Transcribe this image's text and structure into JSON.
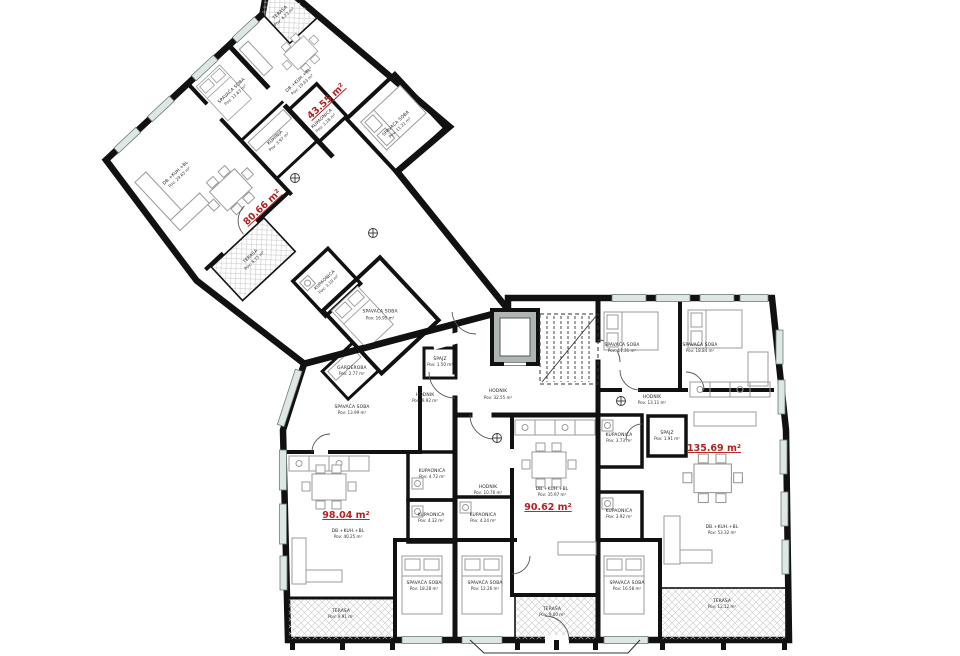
{
  "plan_title": "Floor plan",
  "colors": {
    "wall": "#111111",
    "area_red": "#b22222",
    "furniture": "#9b9b9b",
    "window": "#5a6e66",
    "elevator": "#aeb6b2",
    "hatch": "#c9c9c9"
  },
  "apts": {
    "a43": "43.55 m²",
    "a80": "80.66 m²",
    "a98": "98.04 m²",
    "a90": "90.62 m²",
    "a135": "135.69 m²"
  },
  "rooms": {
    "t43": {
      "n": "TERASA",
      "a": "Pov: 4.23 m²"
    },
    "l43": {
      "n": "DB.+KUH.+BL",
      "a": "Pov: 19.63 m²"
    },
    "k43": {
      "n": "KUPAONICA",
      "a": "Pov: 3.18 m²"
    },
    "b43": {
      "n": "SPAVAĆA SOBA",
      "a": "Pov: 11.21 m²"
    },
    "b1363": {
      "n": "SPAVAĆA SOBA",
      "a": "Pov: 13.63 m²"
    },
    "kuh80": {
      "n": "KUHINJA",
      "a": "Pov: 3.97 m²"
    },
    "l80": {
      "n": "DB.+KUH.+BL",
      "a": "Pov: 29.63 m²"
    },
    "t80": {
      "n": "TERASA",
      "a": "Pov: 8.73 m²"
    },
    "kstr": {
      "n": "KUPAONICA",
      "a": "Pov: 3.10 m²"
    },
    "b1695": {
      "n": "SPAVAĆA SOBA",
      "a": "Pov: 16.95 m²"
    },
    "gard": {
      "n": "GARDEROBA",
      "a": "Pov: 2.77 m²"
    },
    "hmain": {
      "n": "HODNIK",
      "a": "Pov: 32.55 m²"
    },
    "h992": {
      "n": "HODNIK",
      "a": "Pov: 9.92 m²"
    },
    "sp98": {
      "n": "ŠPAJZ",
      "a": "Pov: 1.50 m²"
    },
    "b1399": {
      "n": "SPAVAĆA SOBA",
      "a": "Pov: 13.99 m²"
    },
    "k472": {
      "n": "KUPAONICA",
      "a": "Pov: 4.72 m²"
    },
    "k432": {
      "n": "KUPAONICA",
      "a": "Pov: 4.32 m²"
    },
    "l98": {
      "n": "DB.+KUH.+BL",
      "a": "Pov: 40.25 m²"
    },
    "b1828": {
      "n": "SPAVAĆA SOBA",
      "a": "Pov: 18.28 m²"
    },
    "t991": {
      "n": "TERASA",
      "a": "Pov: 9.91 m²"
    },
    "h1076": {
      "n": "HODNIK",
      "a": "Pov: 10.76 m²"
    },
    "k424": {
      "n": "KUPAONICA",
      "a": "Pov: 4.24 m²"
    },
    "b1226": {
      "n": "SPAVAĆA SOBA",
      "a": "Pov: 12.26 m²"
    },
    "l90": {
      "n": "DB.+KUH.+BL",
      "a": "Pov: 35.97 m²"
    },
    "t900": {
      "n": "TERASA",
      "a": "Pov: 9.00 m²"
    },
    "k373": {
      "n": "KUPAONICA",
      "a": "Pov: 3.73 m²"
    },
    "k392": {
      "n": "KUPAONICA",
      "a": "Pov: 3.92 m²"
    },
    "b1658": {
      "n": "SPAVAĆA SOBA",
      "a": "Pov: 16.58 m²"
    },
    "b1131": {
      "n": "SPAVAĆA SOBA",
      "a": "Pov: 11.31 m²"
    },
    "b1884": {
      "n": "SPAVAĆA SOBA",
      "a": "Pov: 18.84 m²"
    },
    "h1311": {
      "n": "HODNIK",
      "a": "Pov: 13.11 m²"
    },
    "sp135": {
      "n": "ŠPAJZ",
      "a": "Pov: 1.91 m²"
    },
    "l135": {
      "n": "DB.+KUH.+BL",
      "a": "Pov: 53.32 m²"
    },
    "t1212": {
      "n": "TERASA",
      "a": "Pov: 12.12 m²"
    }
  }
}
